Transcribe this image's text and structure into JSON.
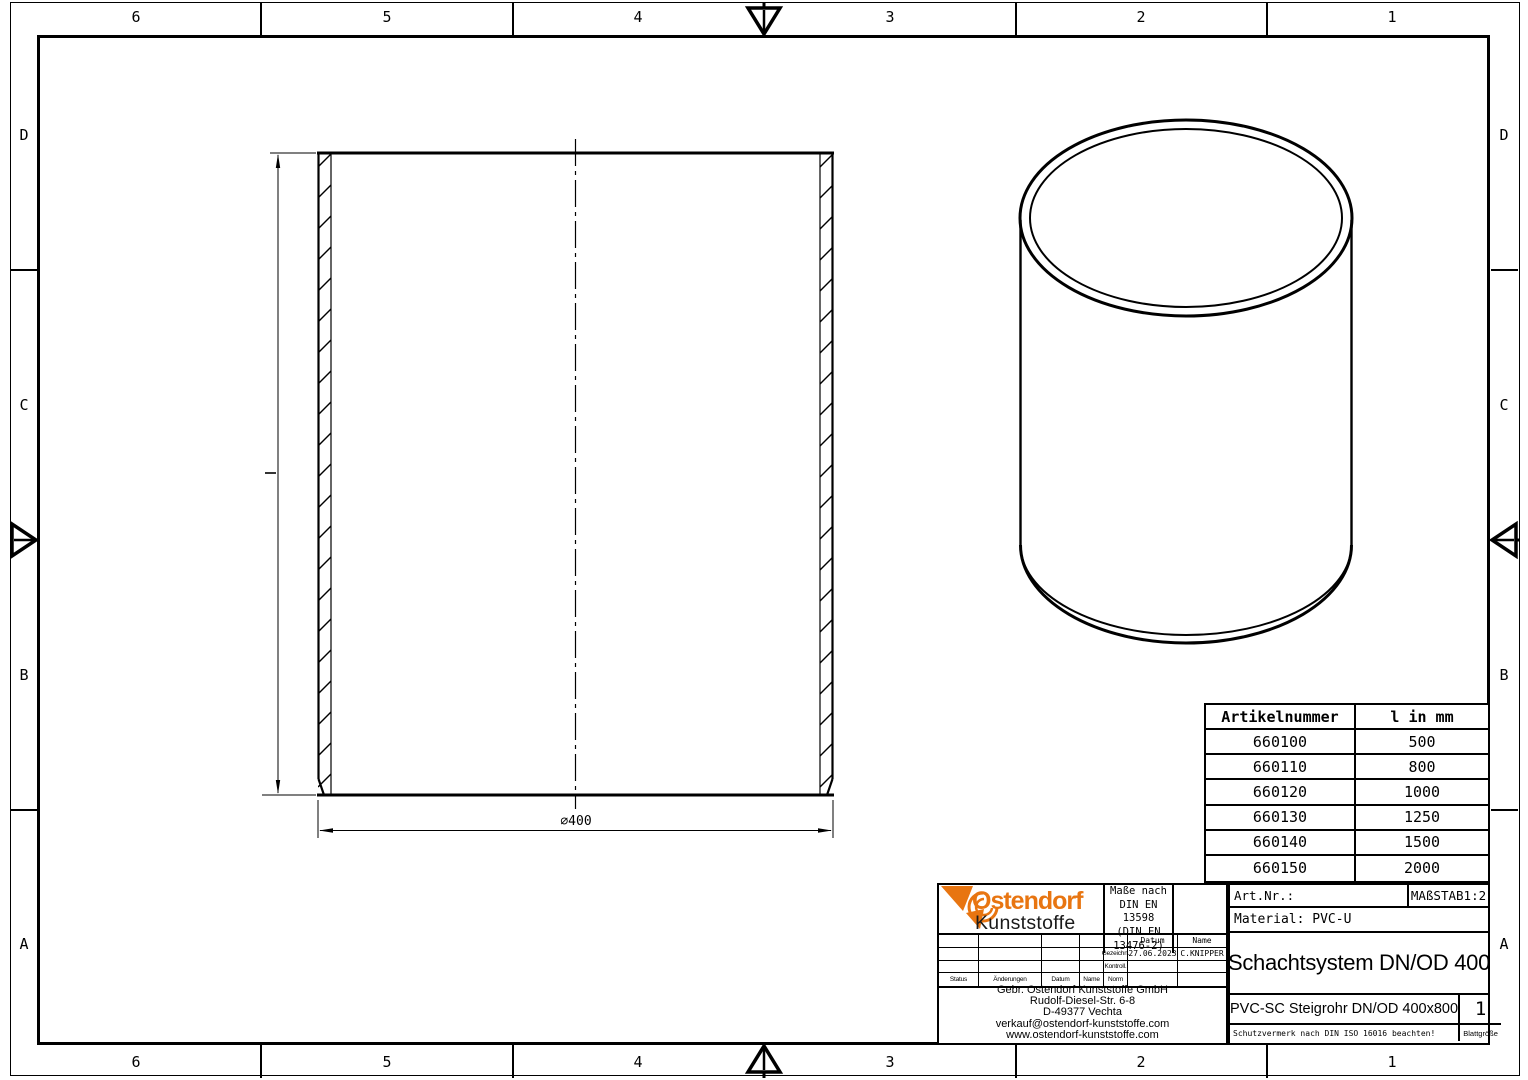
{
  "frame": {
    "columns": [
      "6",
      "5",
      "4",
      "3",
      "2",
      "1"
    ],
    "rows": [
      "D",
      "C",
      "B",
      "A"
    ]
  },
  "front_view": {
    "diameter_label": "⌀400"
  },
  "parts_table": {
    "headers": [
      "Artikelnummer",
      "l in mm"
    ],
    "rows": [
      [
        "660100",
        "500"
      ],
      [
        "660110",
        "800"
      ],
      [
        "660120",
        "1000"
      ],
      [
        "660130",
        "1250"
      ],
      [
        "660140",
        "1500"
      ],
      [
        "660150",
        "2000"
      ]
    ]
  },
  "title_block": {
    "logo_line1": "Ostendorf",
    "logo_line2": "Kunststoffe",
    "brand_orange": "#e87511",
    "standards": {
      "line1": "Maße nach",
      "line2": "DIN EN 13598",
      "line3": "(DIN EN 13476-2)"
    },
    "revision": {
      "header_datum": "Datum",
      "header_name": "Name",
      "gezeichn_label": "Gezeichn.",
      "gezeichn_datum": "27.06.2023",
      "gezeichn_name": "C.KNIPPER",
      "kontroll_label": "Kontroll.",
      "norm_label": "Norm",
      "status_label": "Status",
      "aenderungen_label": "Änderungen",
      "datum_label": "Datum",
      "name_label": "Name"
    },
    "company": {
      "line1": "Gebr. Ostendorf Kunststoffe GmbH",
      "line2": "Rudolf-Diesel-Str. 6-8",
      "line3": "D-49377 Vechta",
      "line4": "verkauf@ostendorf-kunststoffe.com",
      "line5": "www.ostendorf-kunststoffe.com"
    },
    "art_nr_label": "Art.Nr.:",
    "scale": "MAßSTAB1:2",
    "material": "Material: PVC-U",
    "title": "Schachtsystem DN/OD 400",
    "subtitle": "PVC-SC Steigrohr DN/OD 400x800",
    "sheet_number": "1",
    "sheet_size_label": "Blattgröße",
    "protection_note": "Schutzvermerk nach DIN ISO 16016 beachten!"
  }
}
